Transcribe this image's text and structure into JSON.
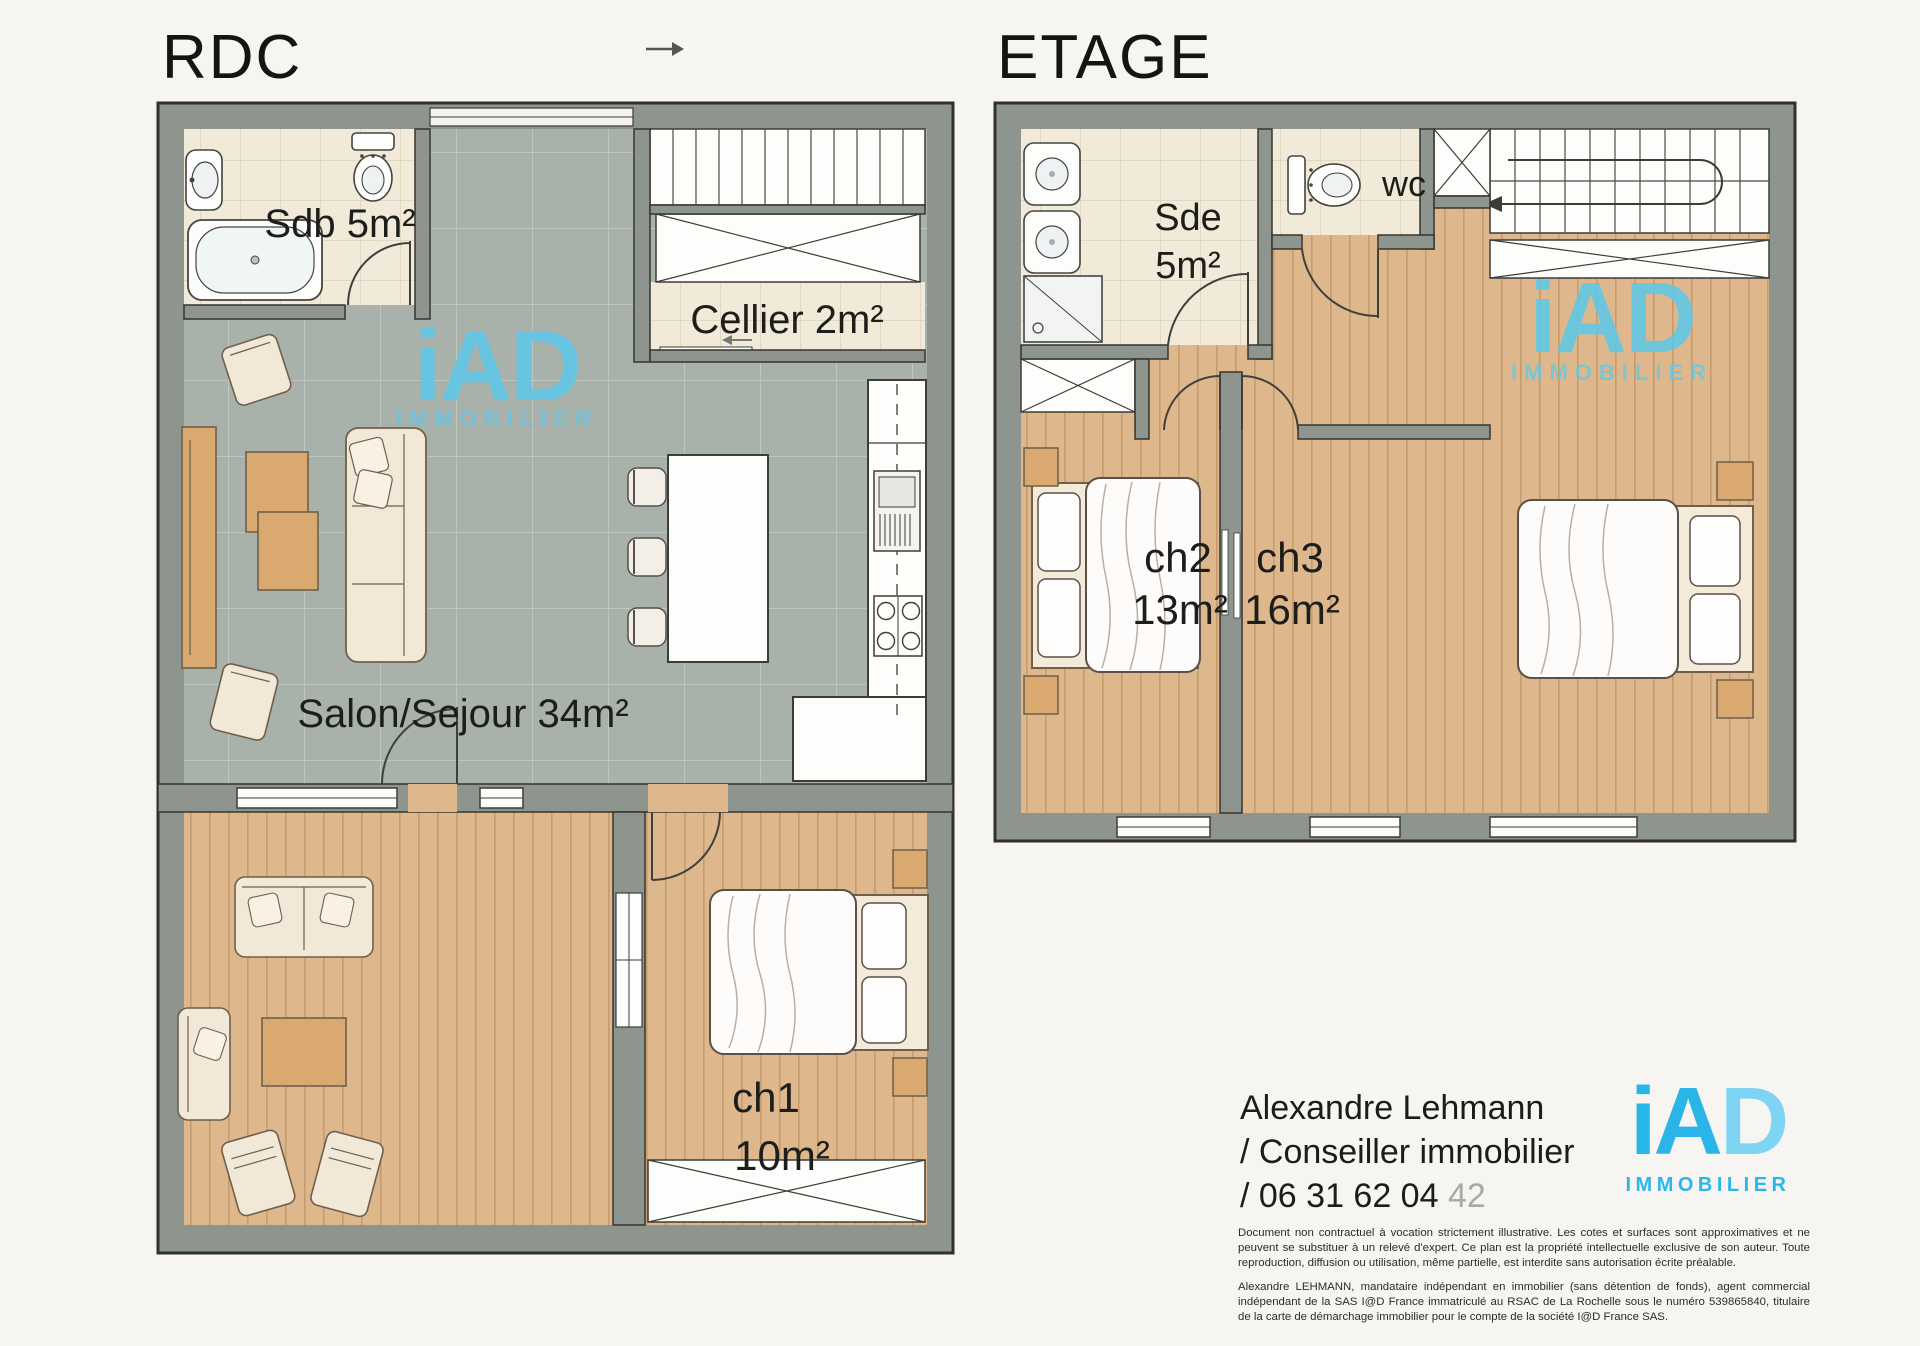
{
  "page": {
    "background": "#f6f5f2"
  },
  "floors": {
    "rdc": {
      "title": "RDC",
      "rooms": {
        "sdb": {
          "label": "Sdb 5m²"
        },
        "cellier": {
          "label": "Cellier 2m²"
        },
        "salon": {
          "label": "Salon/Sejour 34m²"
        },
        "ch1": {
          "name": "ch1",
          "area": "10m²"
        }
      }
    },
    "etage": {
      "title": "ETAGE",
      "rooms": {
        "sde": {
          "name": "Sde",
          "area": "5m²"
        },
        "wc": {
          "label": "wc"
        },
        "ch2": {
          "name": "ch2",
          "area": "13m²"
        },
        "ch3": {
          "name": "ch3",
          "area": "16m²"
        }
      }
    }
  },
  "watermark": {
    "brand": "iAD",
    "subtitle": "IMMOBILIER",
    "color": "#5fc8e9"
  },
  "footer": {
    "logo": {
      "brand_dark": "iA",
      "brand_light": "D",
      "subtitle": "IMMOBILIER",
      "color_primary": "#29b5e8",
      "color_light": "#7fd3f3"
    },
    "contact": {
      "name": "Alexandre Lehmann",
      "role": "/ Conseiller immobilier",
      "phone_prefix": "/ 06 31 62 04 ",
      "phone_suffix": "42"
    },
    "legal": {
      "p1": "Document non contractuel à vocation strictement illustrative. Les cotes et surfaces sont approximatives et ne peuvent se substituer à un relevé d'expert. Ce plan est la propriété intellectuelle exclusive de son auteur. Toute reproduction, diffusion ou utilisation, même partielle, est interdite sans autorisation écrite préalable.",
      "p2": "Alexandre LEHMANN, mandataire indépendant en immobilier (sans détention de fonds), agent commercial indépendant de la SAS I@D France immatriculé au RSAC de La Rochelle sous le numéro 539865840, titulaire de la carte de démarchage immobilier pour le compte de la société I@D France SAS."
    }
  },
  "colors": {
    "wall": "#8e948e",
    "wood_floor": "#deb88c",
    "tile_gray": "#a9b1ab",
    "tile_cream": "#f1ead8",
    "watermark_blue": "#5fc8e9",
    "logo_blue": "#29b5e8",
    "logo_blue_light": "#7fd3f3"
  }
}
